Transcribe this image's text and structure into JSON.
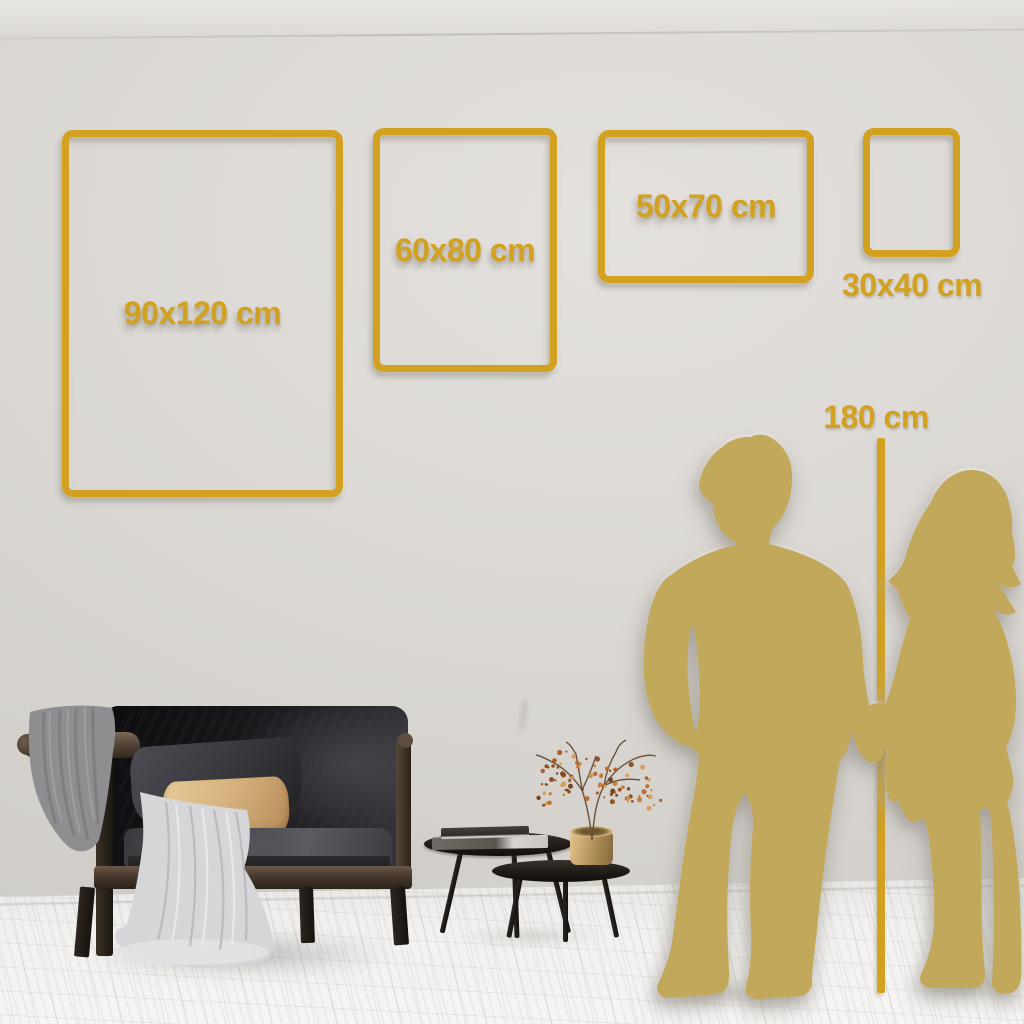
{
  "size_guide": {
    "frames": [
      {
        "label": "90x120 cm"
      },
      {
        "label": "60x80 cm"
      },
      {
        "label": "50x70 cm"
      },
      {
        "label": "30x40 cm"
      }
    ],
    "height_marker": {
      "label": "180 cm"
    }
  },
  "colors": {
    "accent_gold": "#d1a11f",
    "silhouette_gold": "#c2a85a",
    "wall": "#d9d6d2",
    "floor": "#f2f1ef"
  }
}
